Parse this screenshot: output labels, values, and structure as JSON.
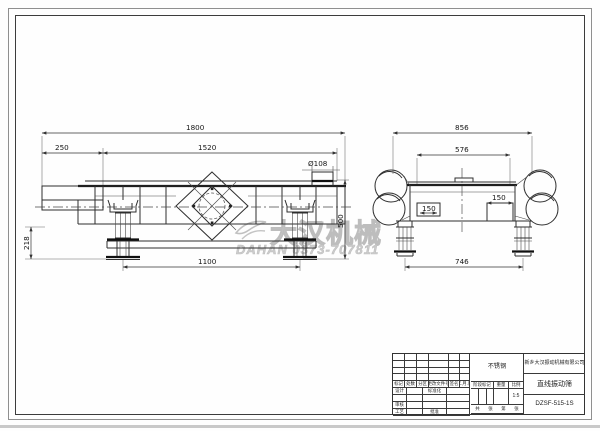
{
  "watermark": {
    "brand_cn": "大汉机械",
    "phone_line": "DAHAN 0373-707811",
    "color": "#c6c6c6"
  },
  "views": {
    "side_view": {
      "dims": {
        "overall_length": "1800",
        "inlet_offset": "250",
        "screen_length": "1520",
        "outlet_dia": "Ø108",
        "base_height": "218",
        "total_height": "500",
        "base_span": "1100"
      }
    },
    "end_view": {
      "dims": {
        "overall_width": "856",
        "body_width": "576",
        "motor_left": "150",
        "motor_right": "150",
        "base_span": "746"
      }
    }
  },
  "title_block": {
    "company": "新乡大汉振动机械有限公司",
    "product": "直线振动筛",
    "model": "DZSF-515-1S",
    "material": "不锈钢",
    "scale_value": "1:5",
    "change_headers": [
      "标记",
      "处数",
      "分区",
      "更改文件号",
      "签名",
      "年.月.日"
    ],
    "stage_headers": [
      "阶段标记",
      "重量",
      "比例"
    ],
    "roles": {
      "design": "设计",
      "standardize": "标准化",
      "review": "审核",
      "process": "工艺",
      "approve": "批准"
    },
    "sheet_labels": [
      "共",
      "张",
      "第",
      "张"
    ]
  },
  "colors": {
    "line": "#2e2e2e",
    "frame": "#3c3c3c",
    "watermark": "#c6c6c6"
  }
}
